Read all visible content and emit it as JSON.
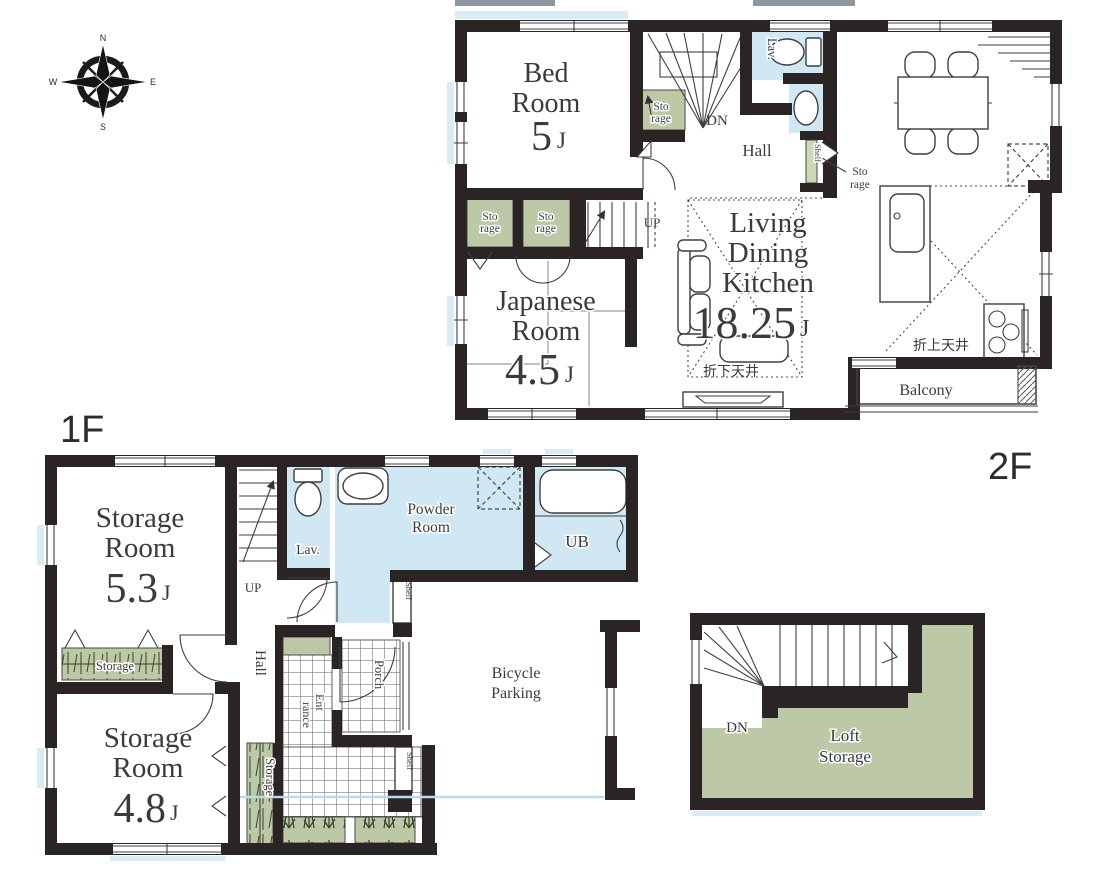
{
  "colors": {
    "wall": "#2a2524",
    "water": "#cfe8f3",
    "green": "#bdc9a6",
    "shelf_green": "#ccd8b4",
    "label": "#3b3b3b",
    "line": "#3f3f3f",
    "faint": "#d9ebf5",
    "gray_bar": "#8e979e"
  },
  "floors": {
    "f1": "1F",
    "f2": "2F"
  },
  "compass": {
    "n": "N",
    "e": "E",
    "s": "S",
    "w": "W"
  },
  "shared": {
    "sto": "Sto",
    "rage": "rage",
    "storage": "Storage",
    "room": "Room",
    "shelf": "Shelf",
    "up": "UP",
    "dn": "DN",
    "lav": "Lav.",
    "hall": "Hall",
    "unit": "J"
  },
  "f2": {
    "bed": "Bed",
    "bed_size": "5",
    "living": "Living",
    "dining": "Dining",
    "kitchen": "Kitchen",
    "ldk_size": "18.25",
    "japanese": "Japanese",
    "jp_size": "4.5",
    "ceil_raised": "折上天井",
    "ceil_lowered": "折下天井",
    "balcony": "Balcony"
  },
  "f1": {
    "sr1_size": "5.3",
    "sr2_size": "4.8",
    "powder": "Powder",
    "ub": "UB",
    "ent1": "Ent",
    "ent2": "rance",
    "porch": "Porch",
    "bike1": "Bicycle",
    "bike2": "Parking"
  },
  "loft": {
    "loft": "Loft"
  }
}
